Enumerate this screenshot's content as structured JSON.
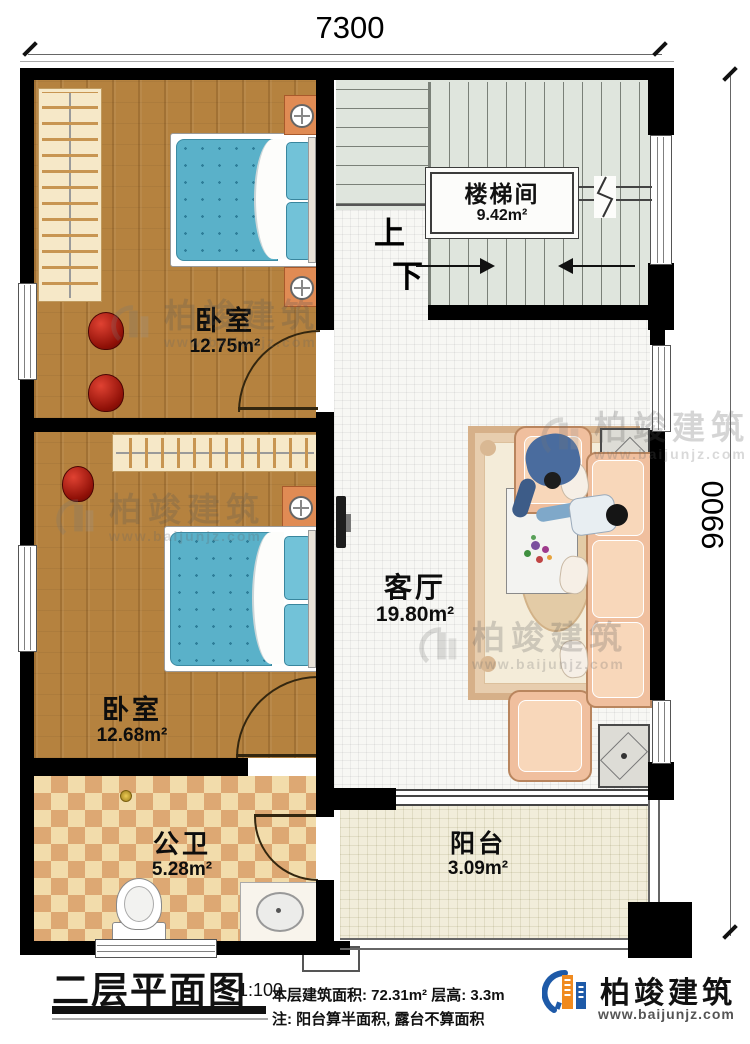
{
  "dimensions": {
    "width_mm": "7300",
    "height_mm": "9900"
  },
  "stairwell": {
    "label": "楼梯间",
    "area": "9.42m²",
    "up": "上",
    "down": "下"
  },
  "rooms": {
    "bedroom_top": {
      "label": "卧室",
      "area": "12.75m²"
    },
    "bedroom_bottom": {
      "label": "卧室",
      "area": "12.68m²"
    },
    "living_room": {
      "label": "客厅",
      "area": "19.80m²"
    },
    "bathroom": {
      "label": "公卫",
      "area": "5.28m²"
    },
    "balcony": {
      "label": "阳台",
      "area": "3.09m²"
    }
  },
  "title_block": {
    "title": "二层平面图",
    "scale": "1:100",
    "info_line1": "本层建筑面积: 72.31m²  层高: 3.3m",
    "info_line2": "注: 阳台算半面积, 露台不算面积"
  },
  "brand": {
    "name": "柏竣建筑",
    "website": "www.baijunjz.com"
  },
  "colors": {
    "wall": "#000000",
    "wood_floor": "#b5823f",
    "stair_floor": "#dfe5dd",
    "bathroom_tile": "#dda873",
    "mattress_blue": "#5ab1c9",
    "sofa_peach": "#f0bf9e",
    "brand_blue": "#1e5aa8",
    "brand_orange": "#f08a1e"
  }
}
